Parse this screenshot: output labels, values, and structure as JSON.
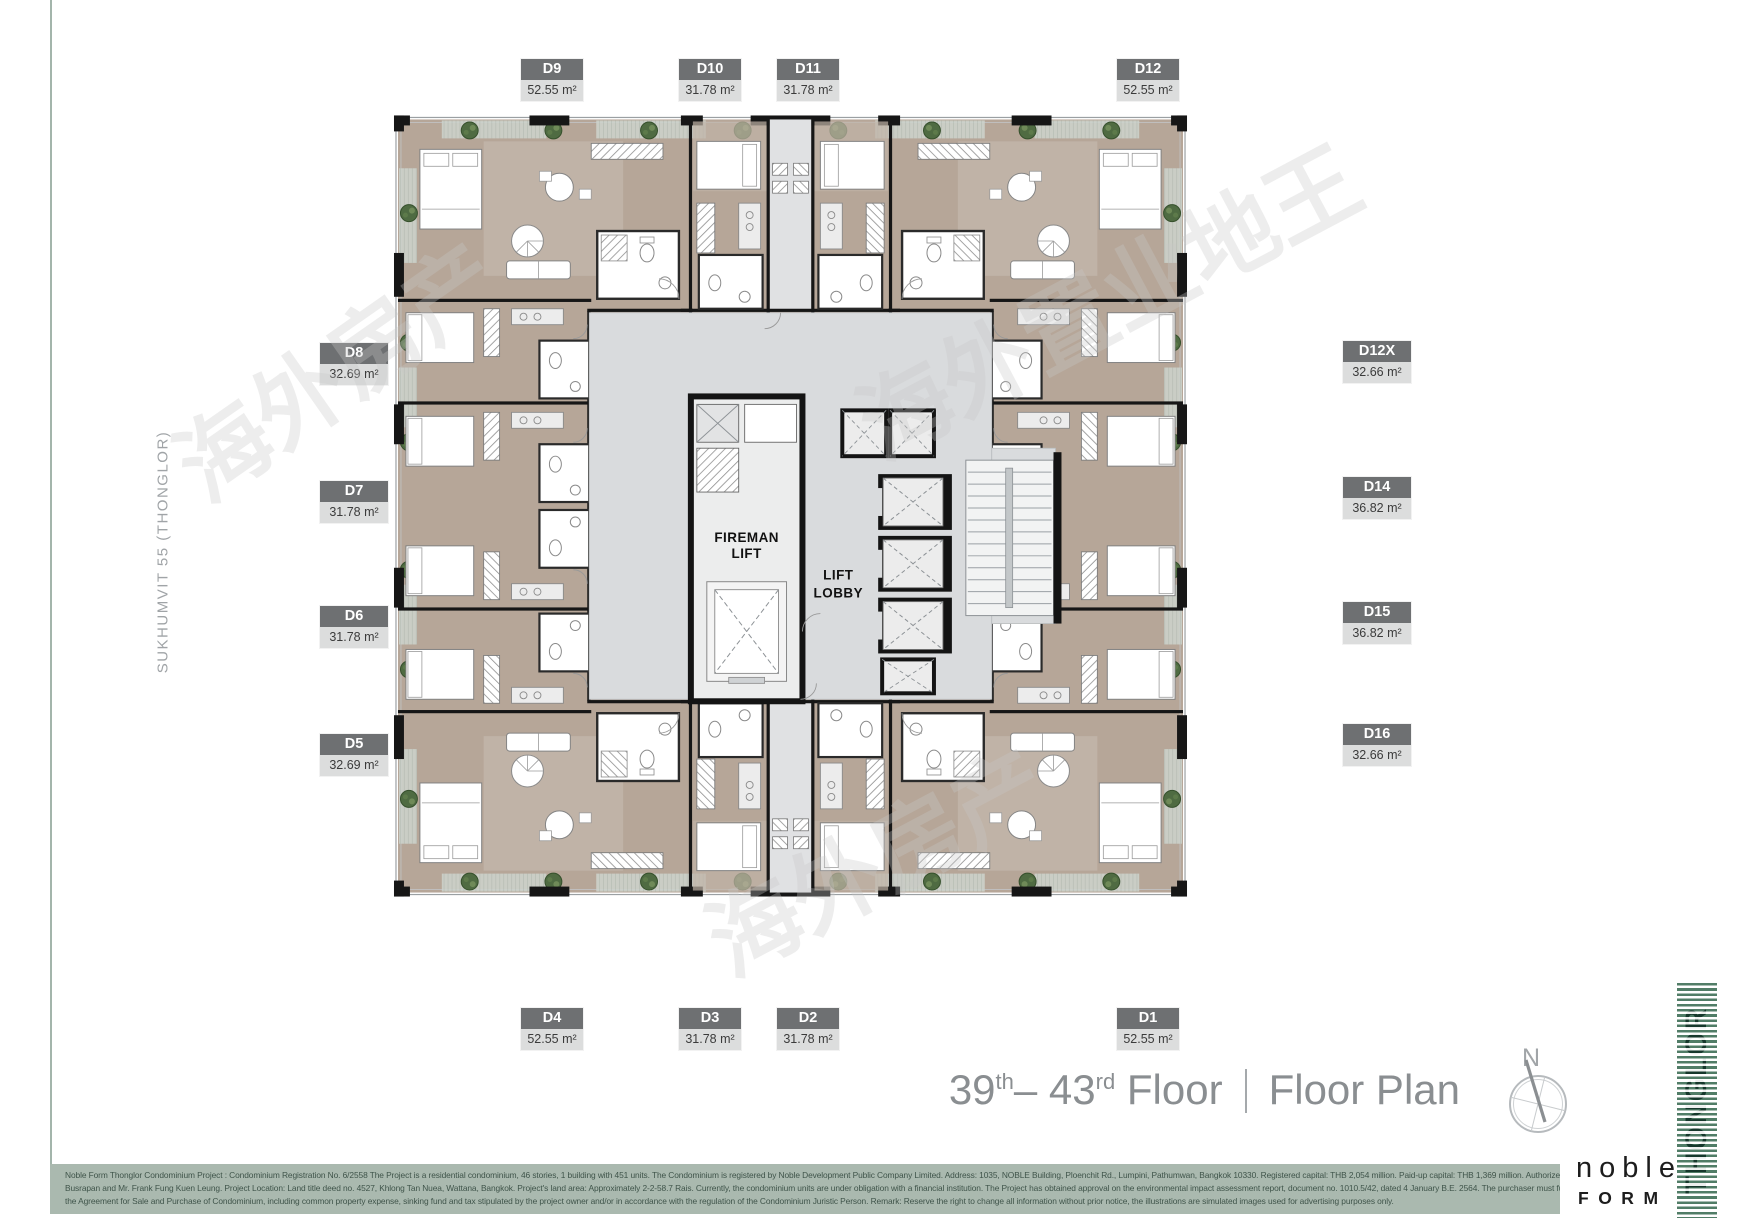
{
  "page": {
    "street_label": "SUKHUMVIT 55 (THONGLOR)"
  },
  "title": {
    "from": "39",
    "from_sup": "th",
    "to": "– 43",
    "to_sup": "rd",
    "floor_word": " Floor",
    "plan_word": "Floor Plan"
  },
  "compass": {
    "north": "N"
  },
  "core": {
    "fireman_line1": "FIREMAN",
    "fireman_line2": "LIFT",
    "lobby_line1": "LIFT",
    "lobby_line2": "LOBBY"
  },
  "units": [
    {
      "id": "D9",
      "area": "52.55 m²",
      "side": "top"
    },
    {
      "id": "D10",
      "area": "31.78 m²",
      "side": "top"
    },
    {
      "id": "D11",
      "area": "31.78 m²",
      "side": "top"
    },
    {
      "id": "D12",
      "area": "52.55 m²",
      "side": "top"
    },
    {
      "id": "D8",
      "area": "32.69 m²",
      "side": "left"
    },
    {
      "id": "D7",
      "area": "31.78 m²",
      "side": "left"
    },
    {
      "id": "D6",
      "area": "31.78 m²",
      "side": "left"
    },
    {
      "id": "D5",
      "area": "32.69 m²",
      "side": "left"
    },
    {
      "id": "D12X",
      "area": "32.66 m²",
      "side": "right"
    },
    {
      "id": "D14",
      "area": "36.82 m²",
      "side": "right"
    },
    {
      "id": "D15",
      "area": "36.82 m²",
      "side": "right"
    },
    {
      "id": "D16",
      "area": "32.66 m²",
      "side": "right"
    },
    {
      "id": "D4",
      "area": "52.55 m²",
      "side": "bottom"
    },
    {
      "id": "D3",
      "area": "31.78 m²",
      "side": "bottom"
    },
    {
      "id": "D2",
      "area": "31.78 m²",
      "side": "bottom"
    },
    {
      "id": "D1",
      "area": "52.55 m²",
      "side": "bottom"
    }
  ],
  "branding": {
    "noble": "noble",
    "form": "FORM",
    "thonglor": "THONGLOR"
  },
  "watermark": {
    "wm1": "海外房产",
    "wm2": "海外置业地王",
    "wm3": "海外房产"
  },
  "disclaimer": {
    "line1": "Noble Form Thonglor Condominium Project : Condominium Registration No. 6/2558 The Project is a residential condominium, 46 stories, 1 building with 451 units. The Condominium is registered by Noble Development Public Company Limited. Address: 1035, NOBLE Building, Ploenchit Rd., Lumpini, Pathumwan, Bangkok 10330. Registered capital: THB 2,054 million. Paid-up capital: THB 1,369 million. Authorized Directors: Mr. Thongchai",
    "line2": "Busrapan and Mr. Frank Fung Kuen Leung. Project Location: Land title deed no. 4527, Khlong Tan Nuea, Wattana, Bangkok. Project's land area: Approximately 2-2-58.7 Rais. Currently, the condominium units are under obligation with a financial institution. The Project has obtained approval on the environmental impact assessment report, document no. 1010.5/42, dated 4 January B.E. 2564. The purchaser must fully pay any payments under",
    "line3": "the Agreement for Sale and Purchase of Condominium, including common property expense, sinking fund and tax stipulated by the project owner and/or in accordance with the regulation of the Condominium Juristic Person. Remark: Reserve the right to change all information without prior notice, the illustrations are simulated images used for advertising purposes only."
  },
  "colors": {
    "accent_green": "#517d67",
    "floor_taupe": "#b6a698",
    "core_gray": "#d9dbdd",
    "label_header": "#6e7072",
    "label_body": "#dcdddd",
    "wall_black": "#161616"
  }
}
